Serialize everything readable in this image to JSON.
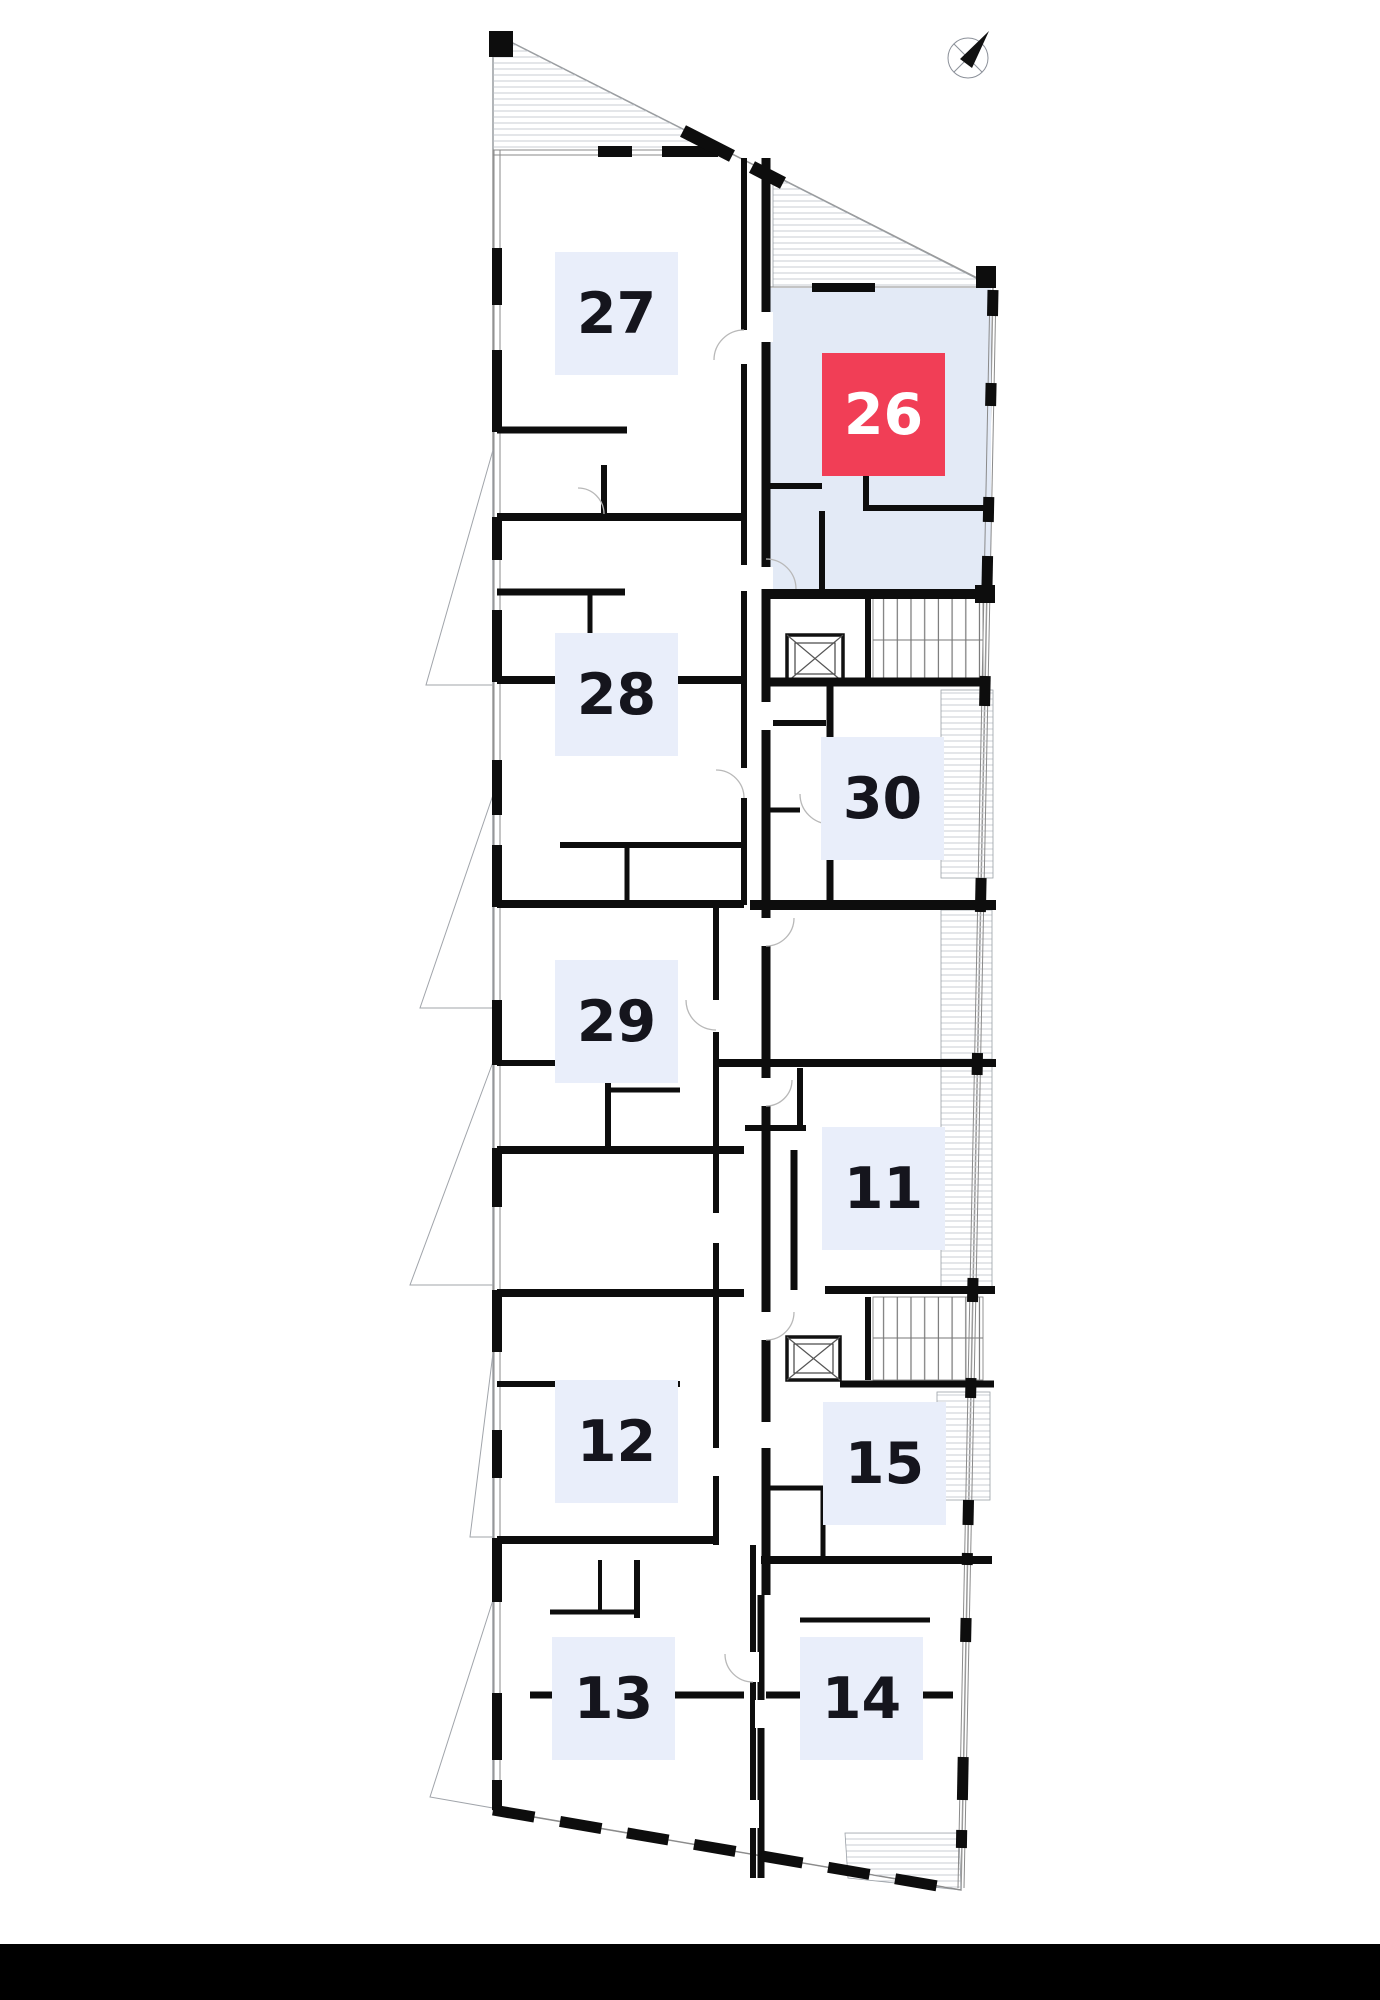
{
  "floor_plan": {
    "selected_unit": "26",
    "units": [
      {
        "number": "27",
        "highlighted": false
      },
      {
        "number": "26",
        "highlighted": true
      },
      {
        "number": "28",
        "highlighted": false
      },
      {
        "number": "30",
        "highlighted": false
      },
      {
        "number": "29",
        "highlighted": false
      },
      {
        "number": "11",
        "highlighted": false
      },
      {
        "number": "12",
        "highlighted": false
      },
      {
        "number": "15",
        "highlighted": false
      },
      {
        "number": "13",
        "highlighted": false
      },
      {
        "number": "14",
        "highlighted": false
      }
    ],
    "colors": {
      "badge_bg": "#e9eefa",
      "badge_text": "#15151d",
      "highlight_bg": "#f13e56",
      "highlight_text": "#ffffff",
      "selected_room_fill": "#e3eaf6",
      "wall": "#0d0d0d",
      "hatch": "#c9ccd3",
      "bottom_bar": "#000000"
    },
    "icons": {
      "compass": "north-arrow-compass"
    }
  }
}
